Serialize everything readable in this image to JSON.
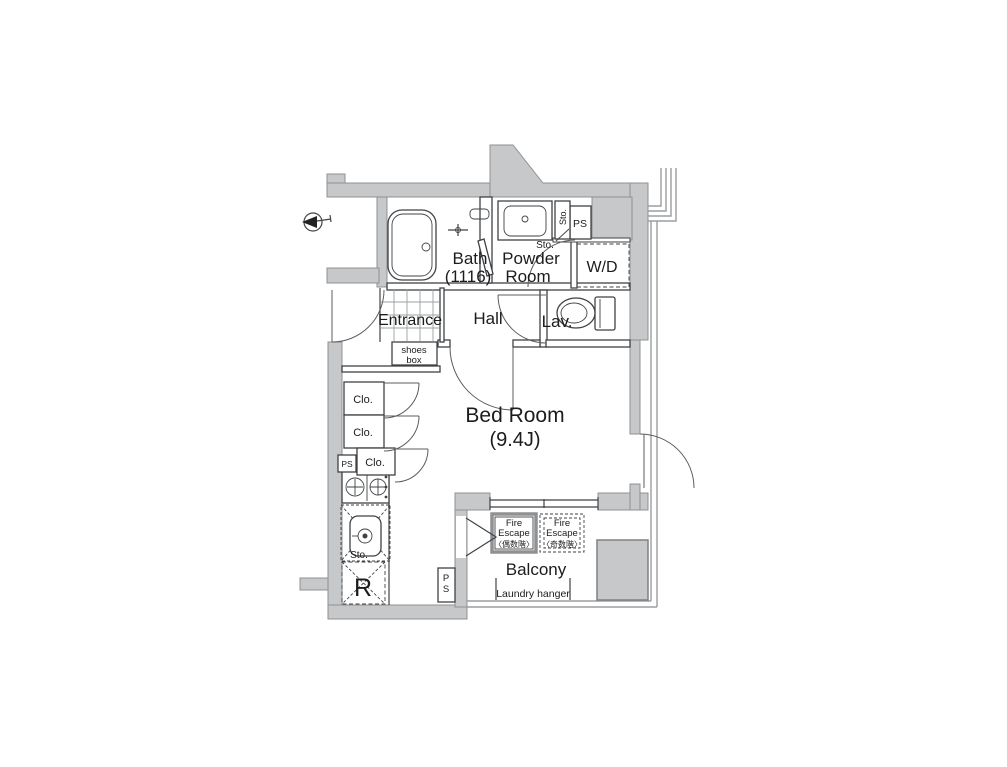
{
  "title": "apartment-floor-plan",
  "rooms": {
    "bath": {
      "line1": "Bath",
      "line2": "(1116)"
    },
    "powder": {
      "line1": "Powder",
      "line2": "Room"
    },
    "wd": "W/D",
    "ps_top": "PS",
    "sto_vertical": "Sto.",
    "sto_leader": "Sto.",
    "entrance": "Entrance",
    "hall": "Hall",
    "lav": "Lav.",
    "shoes_box": {
      "line1": "shoes",
      "line2": "box"
    },
    "bedroom": {
      "line1": "Bed Room",
      "line2": "(9.4J)"
    },
    "clo1": "Clo.",
    "clo2": "Clo.",
    "clo3": "Clo.",
    "ps_left": "PS",
    "sto_kitchen": "Sto.",
    "refrigerator": "R",
    "ps_bottom": {
      "line1": "P",
      "line2": "S"
    },
    "balcony": "Balcony",
    "fire_escape_even": {
      "line1": "Fire",
      "line2": "Escape",
      "line3": "〈偶数階〉"
    },
    "fire_escape_odd": {
      "line1": "Fire",
      "line2": "Escape",
      "line3": "〈奇数階〉"
    },
    "laundry": "Laundry hanger"
  },
  "colors": {
    "wall": "#c6c8ca",
    "wallStroke": "#8f9193",
    "line": "#3f4245",
    "outer": "#9b9da0",
    "text": "#1c1c1c",
    "bg": "#ffffff"
  }
}
